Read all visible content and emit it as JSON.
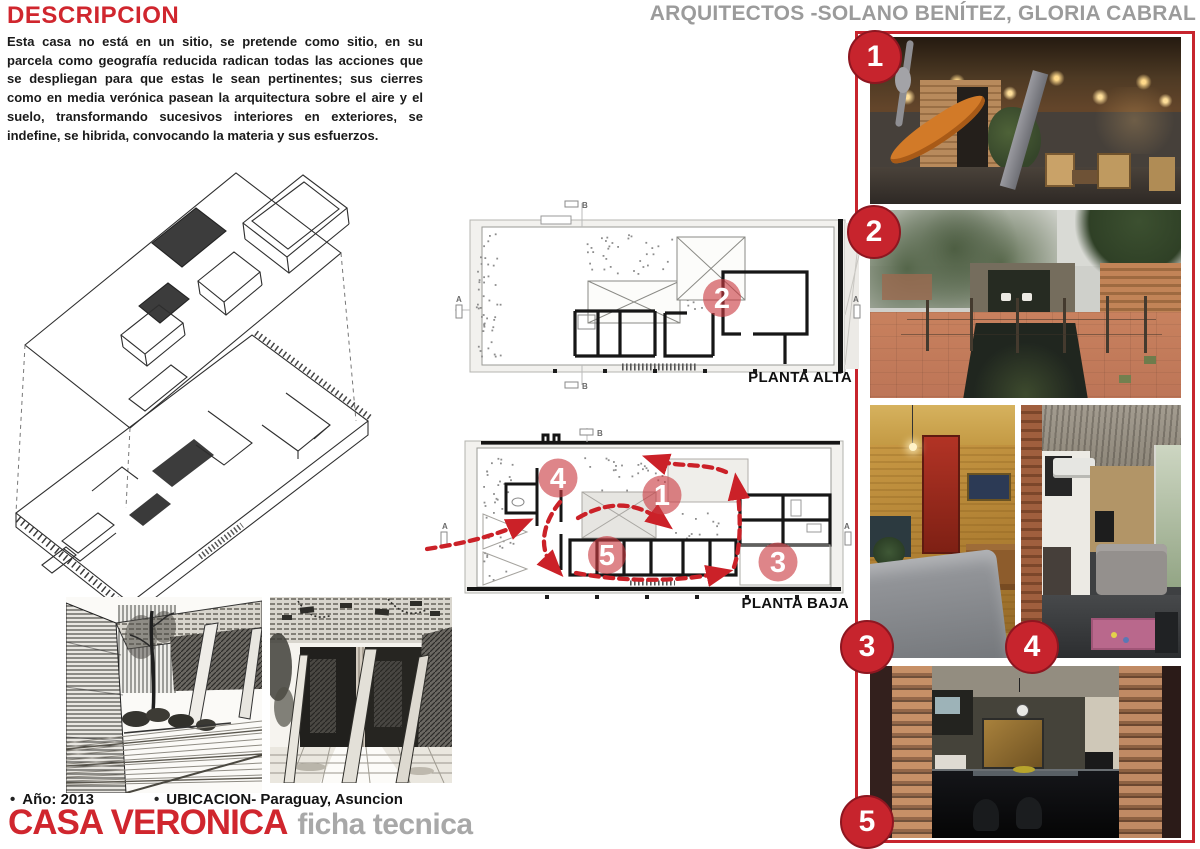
{
  "header": {
    "section_title": "DESCRIPCION",
    "architects": "ARQUITECTOS -SOLANO BENÍTEZ, GLORIA CABRAL"
  },
  "description": "Esta casa no está en un sitio, se pretende como sitio, en su parcela como geografía reducida radican todas las acciones que se despliegan para que estas le sean pertinentes; sus cierres como en media verónica pasean la arquitectura sobre el aire y el suelo, transformando sucesivos interiores en exteriores, se indefine, se hibrida, convocando la materia y sus esfuerzos.",
  "plans": {
    "alta": {
      "label": "PLANTA ALTA",
      "badge": "2",
      "markers": {
        "top": "B",
        "bottom": "B",
        "left": "A",
        "right": "A"
      }
    },
    "baja": {
      "label": "PLANTA BAJA",
      "badges": [
        "4",
        "1",
        "5",
        "3"
      ],
      "markers": {
        "top": "B",
        "left": "A",
        "right": "A"
      }
    }
  },
  "photos": [
    {
      "number": "1",
      "description": "covered patio with orange hammock, brick vault ceiling and lights"
    },
    {
      "number": "2",
      "description": "roof terrace with sunken courtyard opening, brick walls and garden"
    },
    {
      "number": "3",
      "description": "bedroom with golden brick walls, red door and grey bed"
    },
    {
      "number": "4",
      "description": "living room under brick vault with sofa and pink rug"
    },
    {
      "number": "5",
      "description": "kitchen with black counters seen between two brick piers"
    }
  ],
  "footer": {
    "bullet": "•",
    "year": "Año: 2013",
    "location": "UBICACION- Paraguay, Asuncion",
    "project_title": "CASA VERONICA",
    "subtitle": "ficha tecnica"
  },
  "colors": {
    "accent_red": "#c7242d",
    "header_gray": "#9b9b9b",
    "plan_badge_fill": "#c93a41",
    "arrow_red": "#cb2128"
  }
}
